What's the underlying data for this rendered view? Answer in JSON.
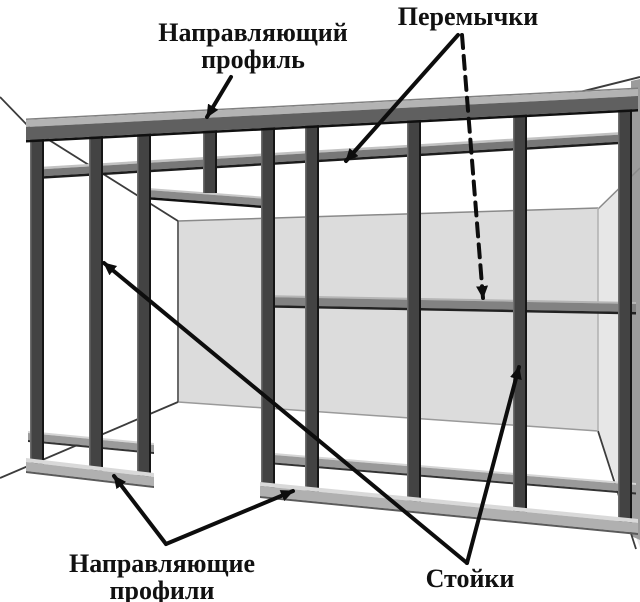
{
  "figure": {
    "kind": "construction-framing-diagram",
    "language": "ru"
  },
  "labels": {
    "top_guide_profile": {
      "line1": "Направляющий",
      "line2": "профиль"
    },
    "crossbars": {
      "line1": "Перемычки"
    },
    "bottom_guide_profiles": {
      "line1": "Направляющие",
      "line2": "профили"
    },
    "studs": {
      "line1": "Стойки"
    }
  },
  "colors": {
    "background": "#ffffff",
    "back_wall": "#dcdcdc",
    "right_wall": "#e7e7e7",
    "right_wall_strip": "#9c9c9c",
    "stud_body": "#434343",
    "stud_edge_dark": "#161616",
    "rail_top_face": "#b3b3b3",
    "rail_front_face": "#606060",
    "crossbar_body": "#787878",
    "lower_crossbar_body": "#9a9a9a",
    "track_face": "#b0b0b0",
    "track_top": "#d9d9d9",
    "arrow": "#0d0d0d",
    "label_text": "#111111"
  }
}
